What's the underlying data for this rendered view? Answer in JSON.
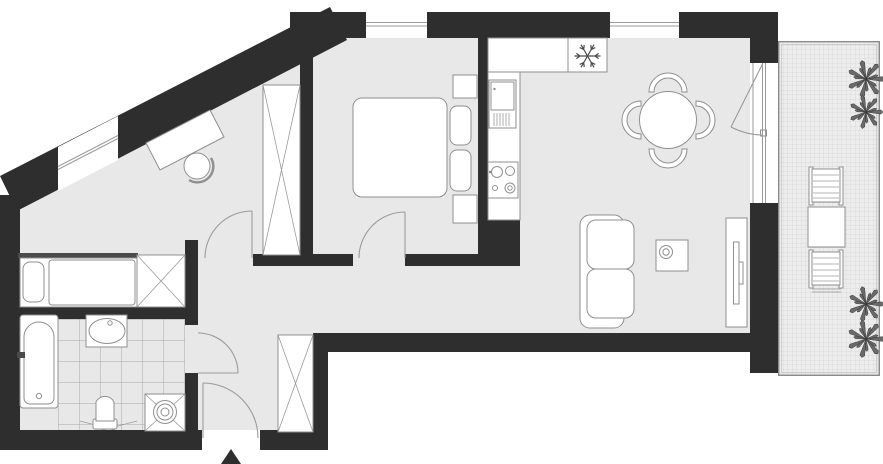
{
  "plan": {
    "type": "apartment-floor-plan",
    "colors": {
      "wall": "#2e2e2e",
      "floor": "#e8e8e8",
      "outline": "#8f8f8f",
      "fixture_fill": "#ffffff",
      "tile_line": "#a9a9a9",
      "balcony_bg": "#ededed",
      "balcony_grid": "#d4d4d4",
      "plant": "#6a6a6a",
      "accent_dark": "#4a4a4a"
    },
    "rooms": [
      {
        "id": "bedroom-office",
        "fixtures": [
          "desk",
          "desk-chair",
          "single-bed",
          "wardrobe",
          "tall-wardrobe"
        ],
        "windows": [
          "diagonal-window"
        ]
      },
      {
        "id": "bedroom-main",
        "fixtures": [
          "double-bed",
          "pillow",
          "pillow",
          "nightstand",
          "nightstand"
        ],
        "windows": [
          "top-window"
        ]
      },
      {
        "id": "kitchen-living-dining",
        "fixtures": [
          "kitchen-counter",
          "fridge-freezer",
          "dishwasher",
          "cooktop",
          "dining-table",
          "sofa",
          "coffee-table",
          "tv-bench",
          "tv"
        ],
        "windows": [
          "top-window",
          "balcony-door"
        ]
      },
      {
        "id": "bathroom",
        "fixtures": [
          "bathtub",
          "washbasin",
          "toilet",
          "washing-machine"
        ],
        "floor": "tiles"
      },
      {
        "id": "hallway",
        "fixtures": [
          "wardrobe"
        ],
        "doors": [
          "entrance-door",
          "bathroom-door",
          "office-door",
          "bedroom-door"
        ]
      },
      {
        "id": "terrace",
        "fixtures": [
          "deck-chair",
          "outdoor-table",
          "deck-chair"
        ],
        "floor": "grid-decking"
      }
    ],
    "dining_chairs": 4,
    "entrance_marker": {
      "shape": "triangle-arrow",
      "x": 231,
      "y": 456
    },
    "fridge_icon": {
      "glyph": "snowflake",
      "x": 587.5,
      "y": 56,
      "r": 13
    },
    "plants": [
      {
        "x": 866,
        "y": 79,
        "r": 17
      },
      {
        "x": 866,
        "y": 112,
        "r": 15
      },
      {
        "x": 866,
        "y": 304,
        "r": 16
      },
      {
        "x": 866,
        "y": 339,
        "r": 17
      }
    ]
  }
}
